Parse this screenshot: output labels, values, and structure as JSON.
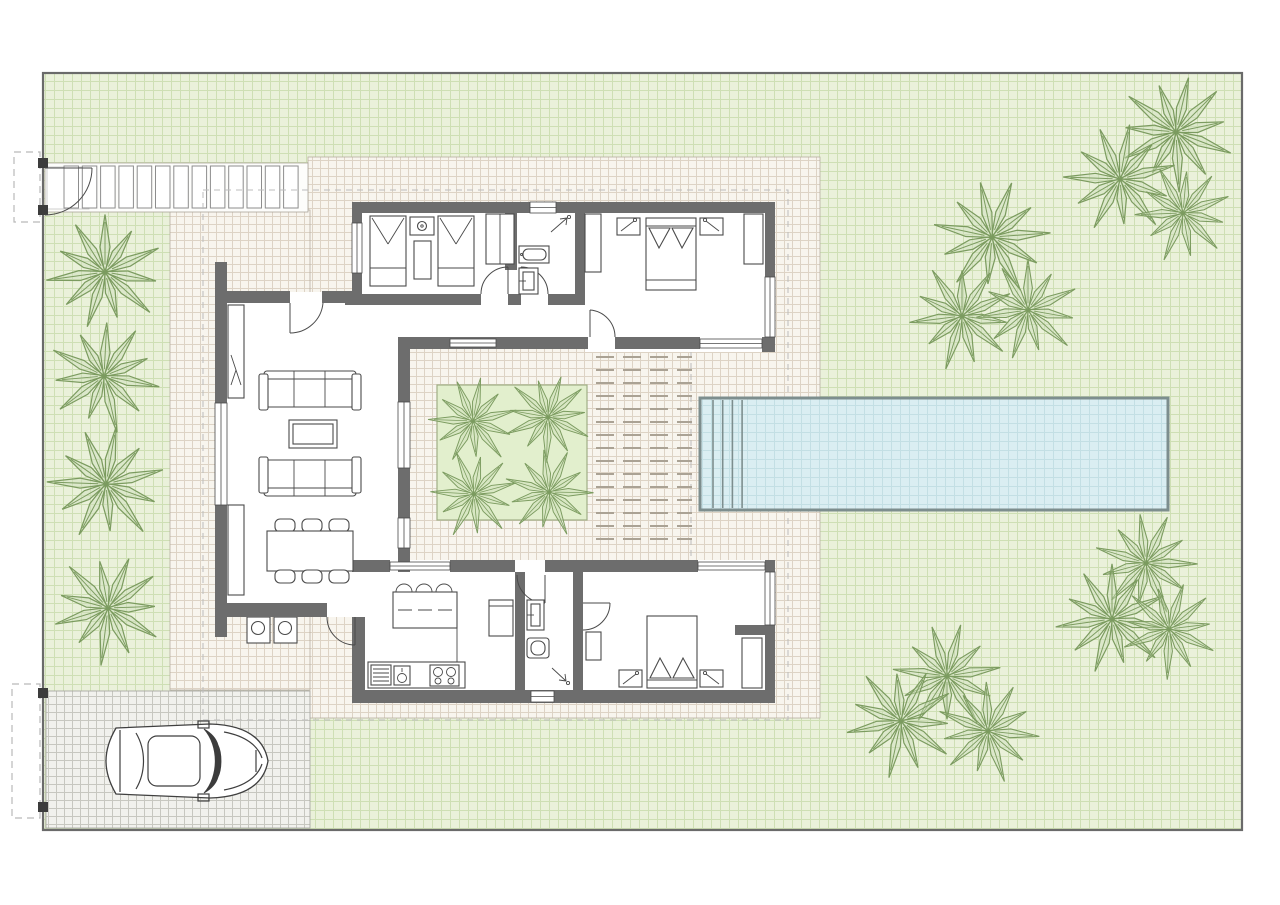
{
  "plan": {
    "type": "villa-site-floor-plan",
    "canvas": {
      "width": 1280,
      "height": 905
    },
    "plot": {
      "x": 43,
      "y": 73,
      "width": 1199,
      "height": 757
    },
    "colors": {
      "lawn": "#eaf1da",
      "lawn_grid": "#cedfb4",
      "terrace": "#f8f5ee",
      "terrace_grid": "#ddd3c5",
      "drive": "#f1f1ed",
      "drive_grid": "#c7c7c0",
      "wall": "#6d6d6d",
      "line": "#4a4a4a",
      "pool_water": "#daeef2",
      "pool_grid": "#c3dfe4",
      "pool_edge": "#7d8e8e",
      "planter": "#e2efcd",
      "planter_edge": "#9fae85",
      "tree_stroke": "#7b9b5f",
      "tree_fill": "#cdddb8",
      "deck_dash": "#aaa294",
      "plot_border": "#6a6a6a",
      "gate_dash": "#b9b9b9"
    },
    "pergola": {
      "slat_count": 13,
      "x0": 64,
      "y": 166,
      "pitch": 18.3,
      "slat_width": 14.5,
      "slat_height": 42
    },
    "pool": {
      "x": 700,
      "y": 398,
      "width": 468,
      "height": 112,
      "step_count": 4,
      "step_x0": 713,
      "step_gap": 9.7
    },
    "garden_trees": [
      [
        105,
        272,
        1.25,
        0
      ],
      [
        104,
        376,
        1.2,
        35
      ],
      [
        106,
        484,
        1.25,
        10
      ],
      [
        108,
        608,
        1.2,
        55
      ],
      [
        992,
        237,
        1.25,
        20
      ],
      [
        962,
        316,
        1.15,
        65
      ],
      [
        1028,
        310,
        1.1,
        0
      ],
      [
        1176,
        132,
        1.25,
        45
      ],
      [
        1120,
        179,
        1.2,
        10
      ],
      [
        1183,
        213,
        1.05,
        70
      ],
      [
        1146,
        563,
        1.1,
        25
      ],
      [
        1112,
        619,
        1.2,
        0
      ],
      [
        1169,
        629,
        1.05,
        50
      ],
      [
        947,
        676,
        1.15,
        15
      ],
      [
        901,
        721,
        1.2,
        60
      ],
      [
        988,
        731,
        1.1,
        30
      ]
    ],
    "courtyard_trees": [
      [
        473,
        421,
        0.95,
        10
      ],
      [
        548,
        417,
        0.95,
        50
      ],
      [
        474,
        494,
        0.95,
        75
      ],
      [
        549,
        492,
        0.95,
        25
      ]
    ],
    "counts": {
      "bedrooms": 3,
      "bathrooms": 2,
      "dining_chairs": 6,
      "island_stools": 3,
      "sofas": 2,
      "cars": 1
    }
  }
}
